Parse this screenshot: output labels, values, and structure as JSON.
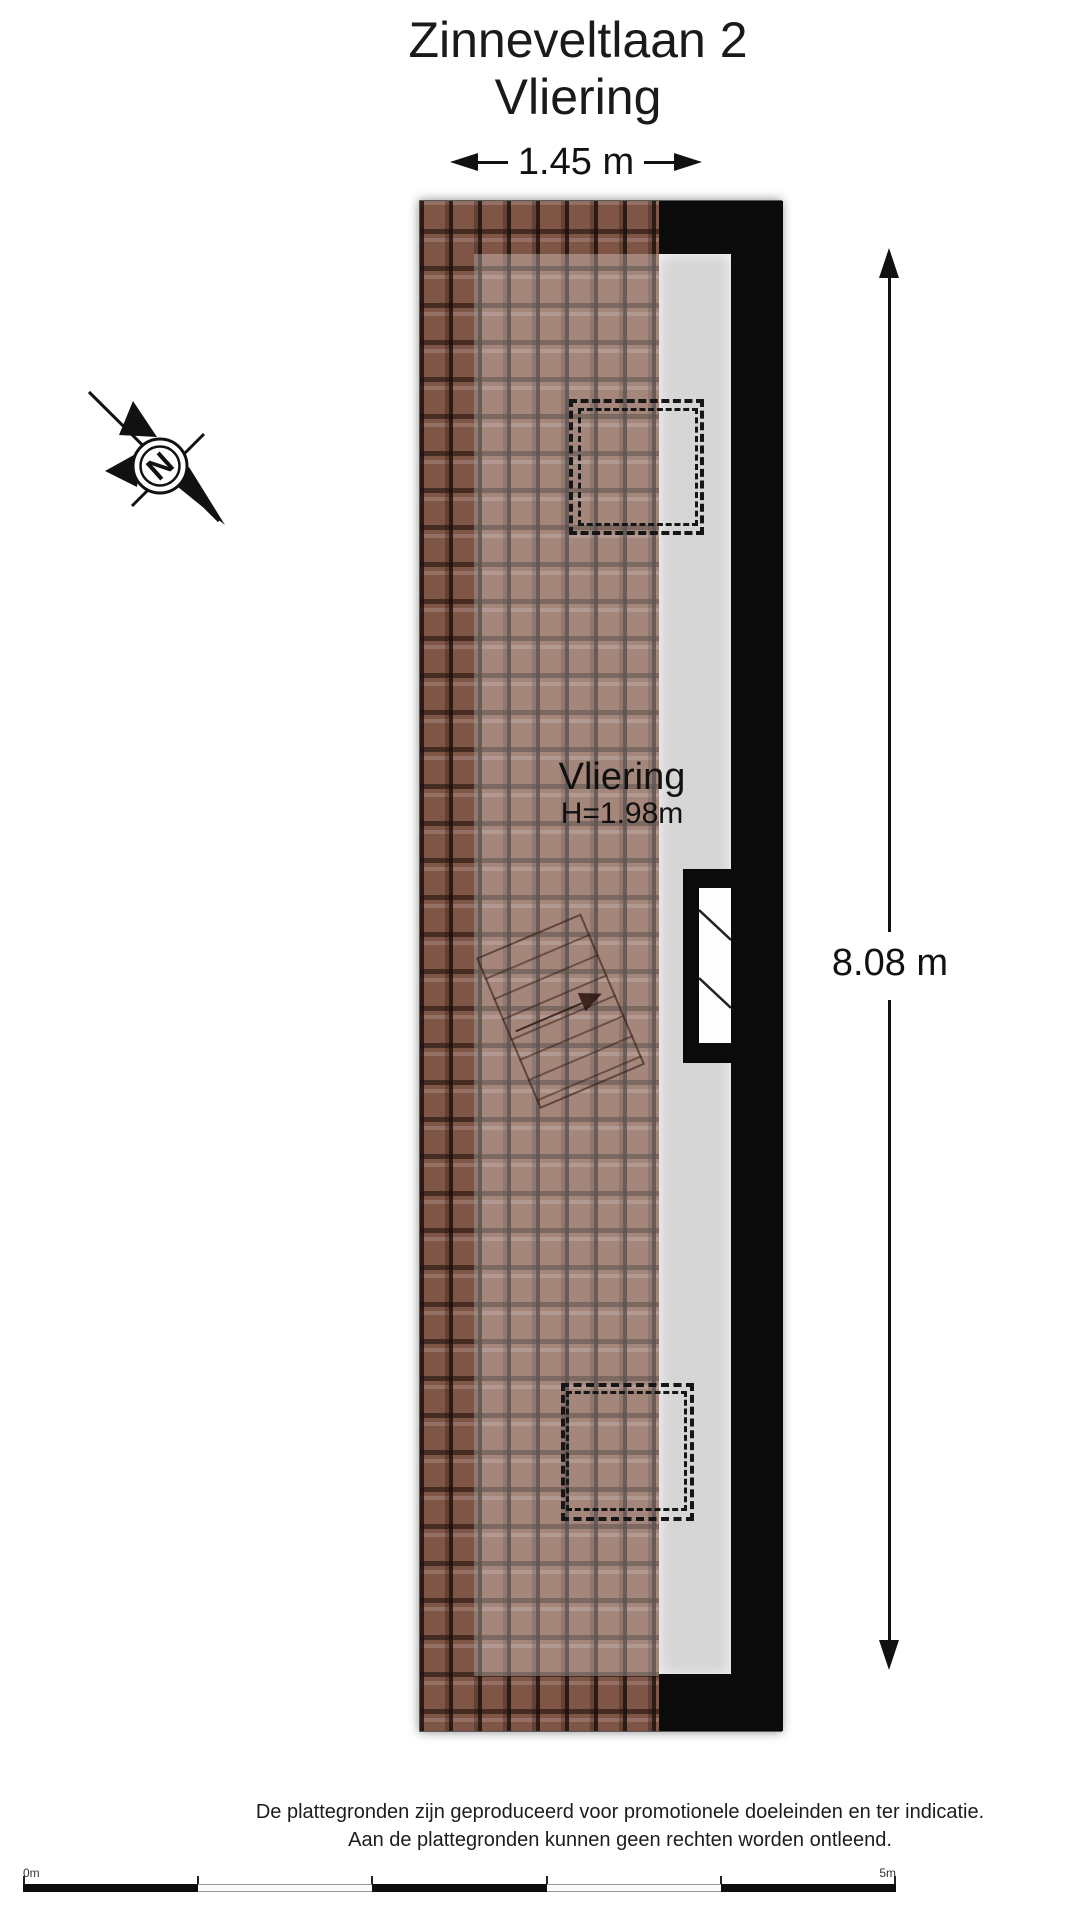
{
  "header": {
    "title_line1": "Zinneveltlaan 2",
    "title_line2": "Vliering"
  },
  "dimensions": {
    "width": "1.45 m",
    "height": "8.08 m"
  },
  "room": {
    "name": "Vliering",
    "ceiling_height": "H=1.98m"
  },
  "compass": {
    "north_letter": "N"
  },
  "disclaimer": {
    "line1": "De plattegronden zijn geproduceerd voor promotionele doeleinden en ter indicatie.",
    "line2": "Aan de plattegronden kunnen geen rechten worden ontleend."
  },
  "scale_bar": {
    "start_label": "0m",
    "end_label": "5m"
  },
  "colors": {
    "roof_tile": "#7f5546",
    "wall": "#0b0b0b",
    "floor": "#d6d6d6",
    "line": "#111111"
  }
}
